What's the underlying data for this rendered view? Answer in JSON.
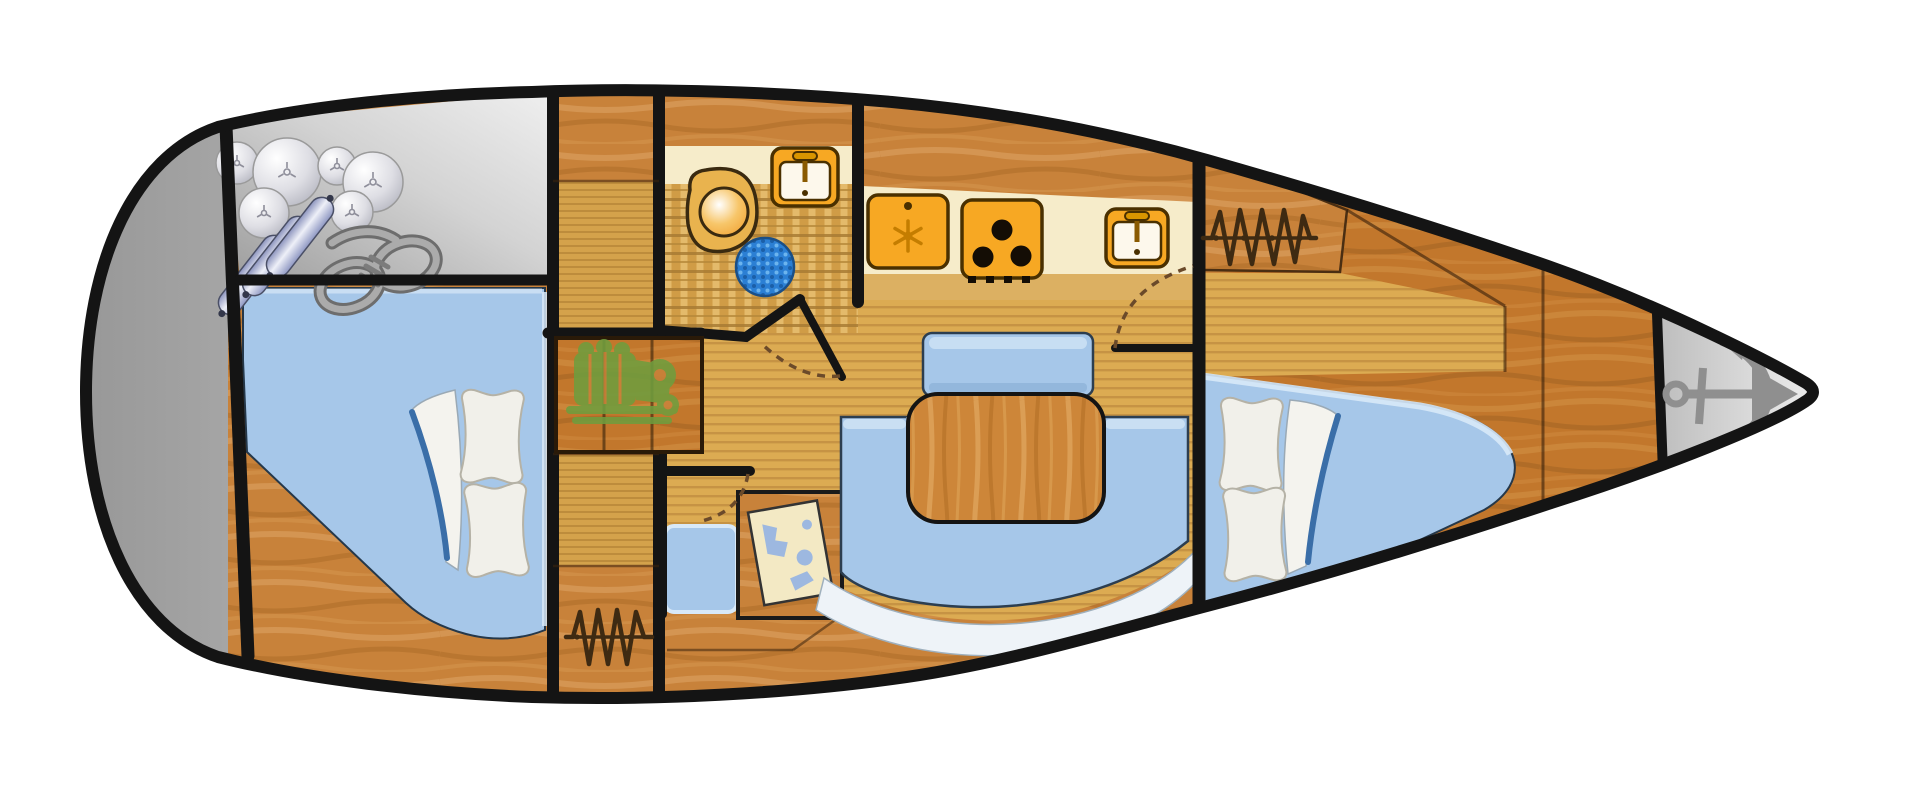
{
  "diagram": {
    "type": "boat-floor-plan",
    "view": "top-down",
    "vessel": "sailboat-interior-layout",
    "background": "#ffffff"
  },
  "colors": {
    "hull_outline": "#141414",
    "silver_light": "#f2f2f2",
    "silver_dark": "#9a9a9a",
    "wood_main": "#c8823a",
    "wood_deep": "#c2772c",
    "floor_tan": "#dcab52",
    "floor_stripe": "#c69344",
    "counter_cream": "#f6ecca",
    "counter_strip": "#dcb062",
    "appliance_orange": "#f7a823",
    "appliance_outline": "#4a3000",
    "bed_blue": "#a6c7e9",
    "bed_highlight": "#d8e9f8",
    "settee_blue": "#a6c7e9",
    "trim_white": "#eef3f8",
    "table_wood": "#cd8639",
    "pillow_white": "#f1f0ea",
    "sheet_blue": "#3a6ea8",
    "shower_blue": "#2b7fd4",
    "engine_green": "#6f9d3e",
    "rope_gray": "#ababab",
    "anchor_gray": "#8f8f8f",
    "fender_blue": "#9aa3c8",
    "map_cream": "#f3e9c4",
    "map_blue": "#9db8e0",
    "hanger_brown": "#3e2a12",
    "door_swing": "#6b4a2a"
  },
  "rooms": [
    {
      "id": "stern-platform",
      "icons": []
    },
    {
      "id": "lazarette-storage",
      "icons": [
        "fender-balls-icon",
        "fender-cylinders-icon",
        "mooring-rope-icon"
      ]
    },
    {
      "id": "aft-cabin",
      "icons": [
        "double-berth",
        "pillows",
        "folded-sheet"
      ]
    },
    {
      "id": "midship-column",
      "icons": [
        "clothes-hangers-icon"
      ]
    },
    {
      "id": "companionway",
      "icons": [
        "steps",
        "engine-icon"
      ]
    },
    {
      "id": "head",
      "icons": [
        "toilet-icon",
        "washbasin-icon",
        "shower-mat-icon"
      ]
    },
    {
      "id": "galley",
      "icons": [
        "refrigerator-icon",
        "stove-icon",
        "sink-icon"
      ]
    },
    {
      "id": "salon",
      "icons": [
        "dinette-table",
        "u-settee",
        "bench-seat"
      ]
    },
    {
      "id": "nav-station",
      "icons": [
        "chart-table",
        "nautical-chart-icon",
        "nav-seat"
      ]
    },
    {
      "id": "forward-cabin",
      "icons": [
        "v-berth",
        "pillows",
        "folded-sheet",
        "clothes-hangers-icon"
      ]
    },
    {
      "id": "anchor-locker",
      "icons": [
        "anchor-icon"
      ]
    }
  ]
}
